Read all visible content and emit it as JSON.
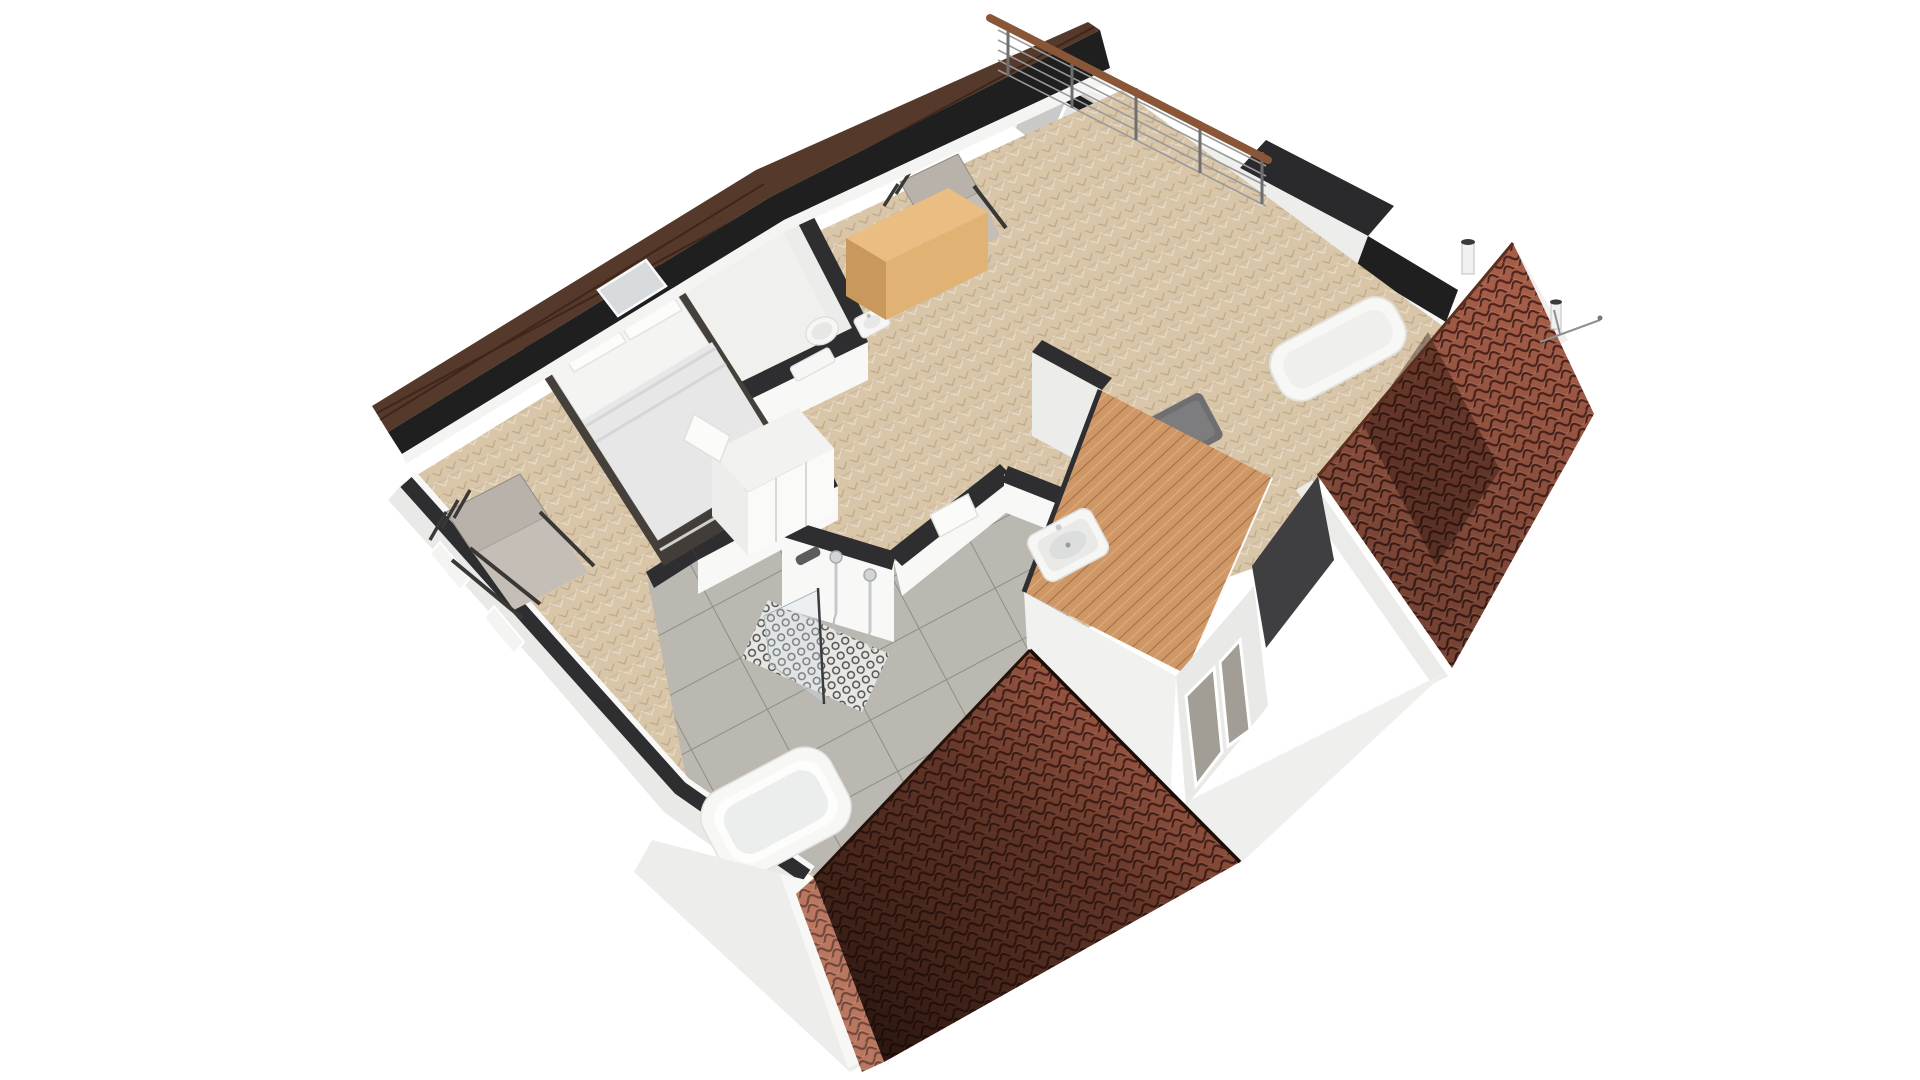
{
  "palette": {
    "background": "#ffffff",
    "wall_cap": "#2e2e30",
    "wall_face": "#f8f8f6",
    "wall_face_shade": "#ececea",
    "wood_floor": "#d9c6a9",
    "tile_floor": "#b8b5af",
    "wc_floor": "#f0f0ed",
    "fascia_wood": "#55392a",
    "fascia_dark": "#1f1f20",
    "roof_tile": "#a85f49",
    "roof_tile_line": "#4f241c",
    "roof_trim": "#ebebe9",
    "deck_wood": "#cf9765",
    "glass": "#e3e6e6",
    "railing_wood": "#8a5638",
    "railing_metal": "#9a9a9a",
    "furniture_fabric": "#b8b2aa",
    "furniture_fabric_light": "#c4beb6",
    "furniture_frame": "#3b3935",
    "bed_mattress": "#f4f4f3",
    "bed_blanket": "#e7e7e8",
    "bed_frame": "#46403b",
    "cabinet_top": "#eabd82",
    "cabinet_front": "#e0b273",
    "cabinet_side": "#c8985c",
    "ceramic": "#f6f6f5",
    "ceramic_inner": "#e7e8e6",
    "chrome": "#c6c9cb",
    "ottoman": "#6f6f71",
    "sofa": "#f7f7f6",
    "ext_facade": "#e9e9e8"
  },
  "scene": {
    "type": "floorplan-3d-dollhouse-render",
    "view": "isometric-top",
    "rooms": [
      {
        "name": "bedroom",
        "floor": "herringbone-oak",
        "furniture": [
          "double-bed",
          "armchair",
          "wardrobe-closet"
        ]
      },
      {
        "name": "wc",
        "floor": "light-tile",
        "furniture": [
          "wall-hung-toilet",
          "hand-basin"
        ]
      },
      {
        "name": "landing",
        "floor": "herringbone-oak",
        "furniture": [
          "armchair",
          "oak-sideboard",
          "daybed-sofa",
          "ottoman"
        ]
      },
      {
        "name": "bathroom",
        "floor": "gray-tile",
        "furniture": [
          "freestanding-bathtub",
          "walk-in-shower",
          "washbasin"
        ]
      }
    ],
    "exterior": [
      "balcony-wire-railing-with-wood-handrail",
      "sliding-glass-doors",
      "roof-edge-fascia",
      "skylight",
      "terracotta-roof-right",
      "terracotta-roof-front",
      "dormer-with-wood-deck",
      "gable-wall",
      "chimney-pipes",
      "antenna"
    ]
  }
}
